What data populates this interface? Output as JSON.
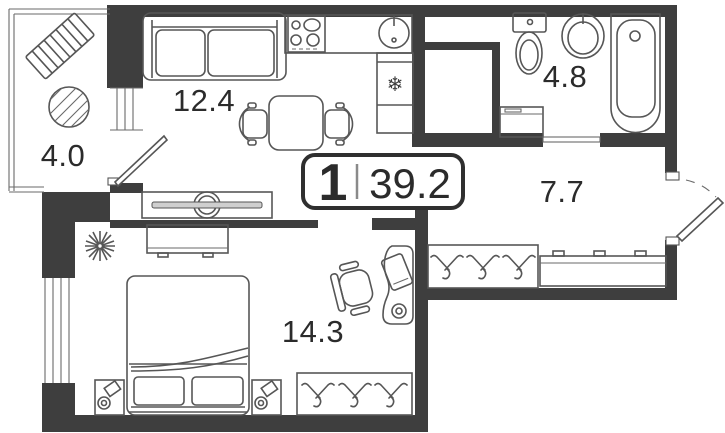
{
  "plan": {
    "type": "apartment-floor-plan",
    "badge": {
      "rooms_count": "1",
      "total_area": "39.2"
    },
    "rooms": {
      "balcony": {
        "area": "4.0"
      },
      "kitchen_living": {
        "area": "12.4"
      },
      "bathroom": {
        "area": "4.8"
      },
      "hallway": {
        "area": "7.7"
      },
      "bedroom": {
        "area": "14.3"
      }
    },
    "icons": {
      "fridge_snowflake": "❄"
    },
    "colors": {
      "wall": "#3e3e3e",
      "furniture_stroke": "#565656",
      "text": "#2b2b2b",
      "background": "#ffffff"
    }
  }
}
